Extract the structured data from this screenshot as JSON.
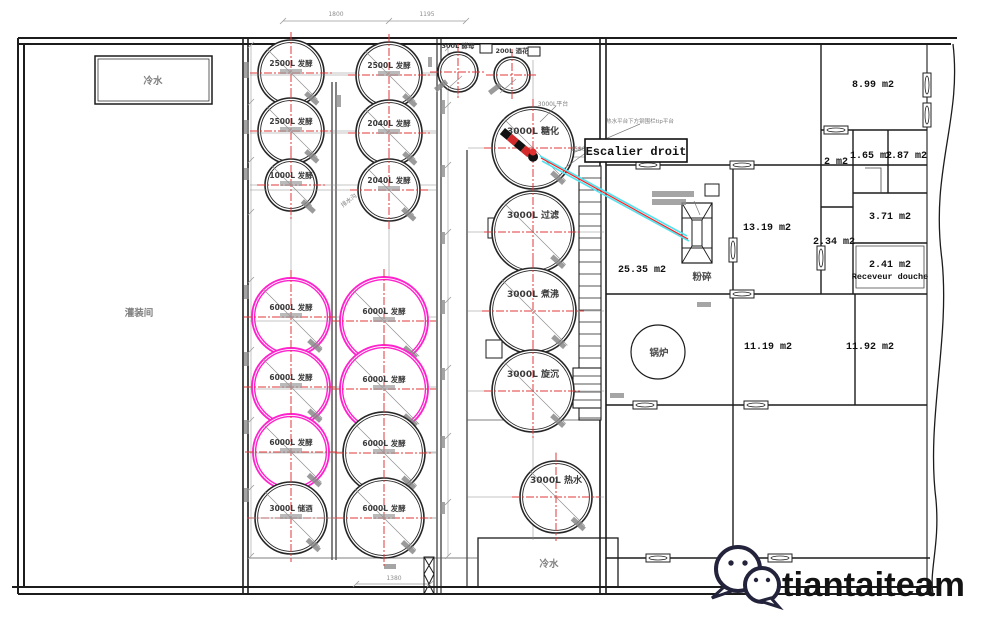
{
  "watermark": {
    "text": "tiantaiteam"
  },
  "colors": {
    "wall": "#1c1c1c",
    "magenta": "#ff22cc",
    "red_centerline": "#e03a3a",
    "red_line": "#ff2020",
    "cyan_line": "#55e2ef",
    "gray_text": "#808080",
    "dim_gray": "#8e8e8e"
  },
  "callouts": {
    "escalier": "Escalier droit",
    "platform": "3000L平台",
    "rail_note": "热水平台下方钢围栏tip平台",
    "drain": "排水沟"
  },
  "tanks": [
    {
      "cx": 291,
      "cy": 73,
      "r": 33,
      "label": "2500L 发酵",
      "style": "black"
    },
    {
      "cx": 291,
      "cy": 131,
      "r": 33,
      "label": "2500L 发酵",
      "style": "black"
    },
    {
      "cx": 291,
      "cy": 185,
      "r": 26,
      "label": "1000L 发酵",
      "style": "black"
    },
    {
      "cx": 389,
      "cy": 75,
      "r": 33,
      "label": "2500L 发酵",
      "style": "black"
    },
    {
      "cx": 389,
      "cy": 133,
      "r": 33,
      "label": "2040L 发酵",
      "style": "black"
    },
    {
      "cx": 389,
      "cy": 190,
      "r": 31,
      "label": "2040L 发酵",
      "style": "black"
    },
    {
      "cx": 291,
      "cy": 317,
      "r": 39,
      "label": "6000L 发酵",
      "style": "magenta"
    },
    {
      "cx": 291,
      "cy": 387,
      "r": 39,
      "label": "6000L 发酵",
      "style": "magenta"
    },
    {
      "cx": 291,
      "cy": 452,
      "r": 38,
      "label": "6000L 发酵",
      "style": "magenta"
    },
    {
      "cx": 291,
      "cy": 518,
      "r": 36,
      "label": "3000L 储酒",
      "style": "black"
    },
    {
      "cx": 384,
      "cy": 321,
      "r": 44,
      "label": "6000L 发酵",
      "style": "magenta"
    },
    {
      "cx": 384,
      "cy": 389,
      "r": 44,
      "label": "6000L 发酵",
      "style": "magenta"
    },
    {
      "cx": 384,
      "cy": 453,
      "r": 41,
      "label": "6000L 发酵",
      "style": "black"
    },
    {
      "cx": 384,
      "cy": 518,
      "r": 40,
      "label": "6000L 发酵",
      "style": "black"
    },
    {
      "cx": 533,
      "cy": 148,
      "r": 41,
      "label": "3000L 糖化",
      "style": "black"
    },
    {
      "cx": 533,
      "cy": 232,
      "r": 41,
      "label": "3000L 过滤",
      "style": "black"
    },
    {
      "cx": 533,
      "cy": 311,
      "r": 43,
      "label": "3000L 煮沸",
      "style": "black"
    },
    {
      "cx": 533,
      "cy": 391,
      "r": 41,
      "label": "3000L 旋沉",
      "style": "black"
    },
    {
      "cx": 556,
      "cy": 497,
      "r": 36,
      "label": "3000L 热水",
      "style": "black"
    },
    {
      "cx": 458,
      "cy": 72,
      "r": 20,
      "label": "300L 酵母",
      "style": "small"
    },
    {
      "cx": 512,
      "cy": 75,
      "r": 18,
      "label": "200L 酒花",
      "style": "small"
    }
  ],
  "rooms": [
    {
      "x": 873,
      "y": 87,
      "t": "8.99 m2"
    },
    {
      "x": 836,
      "y": 164,
      "t": "2 m2"
    },
    {
      "x": 871,
      "y": 158,
      "t": "1.65 m2"
    },
    {
      "x": 906,
      "y": 158,
      "t": "1.87 m2"
    },
    {
      "x": 890,
      "y": 219,
      "t": "3.71 m2"
    },
    {
      "x": 834,
      "y": 244,
      "t": "2.34 m2"
    },
    {
      "x": 890,
      "y": 267,
      "t": "2.41 m2"
    },
    {
      "x": 890,
      "y": 279,
      "t": "Receveur douche",
      "small": true
    },
    {
      "x": 767,
      "y": 230,
      "t": "13.19 m2"
    },
    {
      "x": 642,
      "y": 272,
      "t": "25.35 m2"
    },
    {
      "x": 702,
      "y": 280,
      "t": "粉碎",
      "cjk": true
    },
    {
      "x": 659,
      "y": 356,
      "t": "锅炉",
      "cjk": true
    },
    {
      "x": 768,
      "y": 349,
      "t": "11.19 m2"
    },
    {
      "x": 870,
      "y": 349,
      "t": "11.92 m2"
    },
    {
      "x": 139,
      "y": 316,
      "t": "灌装间",
      "cjk": true,
      "gray": true
    },
    {
      "x": 153,
      "y": 84,
      "t": "冷水",
      "cjk": true,
      "gray": true
    },
    {
      "x": 549,
      "y": 567,
      "t": "冷水",
      "cjk": true,
      "gray": true
    }
  ],
  "dimensions": [
    {
      "x": 336,
      "y": 16,
      "t": "1800"
    },
    {
      "x": 427,
      "y": 16,
      "t": "1195"
    },
    {
      "x": 578,
      "y": 151,
      "t": "1580"
    },
    {
      "x": 394,
      "y": 580,
      "t": "1380"
    }
  ],
  "geometry": {
    "windows_h": [
      [
        648,
        165
      ],
      [
        742,
        165
      ],
      [
        742,
        294
      ],
      [
        645,
        405
      ],
      [
        756,
        405
      ],
      [
        658,
        558
      ],
      [
        780,
        558
      ],
      [
        836,
        130
      ]
    ],
    "windows_v": [
      [
        927,
        85
      ],
      [
        927,
        115
      ],
      [
        733,
        250
      ],
      [
        821,
        258
      ]
    ],
    "valves": [
      [
        488,
        218,
        14,
        20
      ],
      [
        486,
        340,
        16,
        18
      ],
      [
        480,
        44,
        12,
        9
      ],
      [
        528,
        47,
        12,
        9
      ],
      [
        705,
        184,
        14,
        12
      ]
    ],
    "stairs": [
      {
        "x": 579,
        "y": 166,
        "w": 22,
        "h": 254,
        "step": 12
      },
      {
        "x": 573,
        "y": 368,
        "w": 28,
        "h": 40,
        "step": 8
      }
    ],
    "smudges": [
      [
        249,
        62,
        16,
        5,
        90
      ],
      [
        249,
        120,
        14,
        5,
        90
      ],
      [
        249,
        168,
        12,
        5,
        90
      ],
      [
        249,
        285,
        14,
        5,
        90
      ],
      [
        249,
        352,
        14,
        5,
        90
      ],
      [
        249,
        420,
        14,
        5,
        90
      ],
      [
        249,
        488,
        14,
        5,
        90
      ],
      [
        445,
        100,
        14,
        5,
        90
      ],
      [
        445,
        165,
        12,
        5,
        90
      ],
      [
        445,
        232,
        12,
        5,
        90
      ],
      [
        445,
        300,
        14,
        5,
        90
      ],
      [
        445,
        368,
        12,
        5,
        90
      ],
      [
        445,
        436,
        12,
        5,
        90
      ],
      [
        445,
        502,
        12,
        5,
        90
      ],
      [
        341,
        95,
        12,
        5,
        90
      ],
      [
        432,
        57,
        10,
        4,
        90
      ],
      [
        652,
        191,
        42,
        6,
        0
      ],
      [
        652,
        199,
        34,
        6,
        0
      ],
      [
        697,
        302,
        14,
        5,
        0
      ],
      [
        610,
        393,
        14,
        5,
        0
      ],
      [
        384,
        564,
        12,
        5,
        0
      ]
    ],
    "dimchains_v": [
      {
        "x": 251,
        "ys": [
          45,
          102,
          160,
          212,
          280,
          350,
          420,
          488,
          556
        ]
      },
      {
        "x": 448,
        "ys": [
          48,
          105,
          165,
          232,
          300,
          368,
          436,
          502,
          556
        ]
      }
    ],
    "dimchains_h": [
      {
        "y": 21,
        "xs": [
          283,
          389,
          466
        ]
      },
      {
        "y": 584,
        "xs": [
          356,
          430
        ]
      },
      {
        "y": 157,
        "xs": [
          549,
          600
        ]
      }
    ]
  }
}
